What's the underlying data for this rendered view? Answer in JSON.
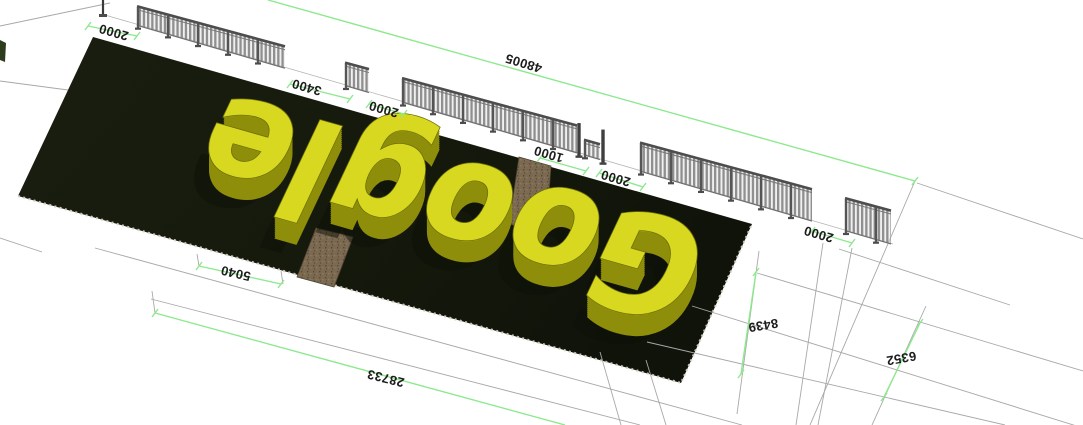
{
  "scene": {
    "letters_word": "Google",
    "colors": {
      "background": "#ffffff",
      "ground_plot": "#161a0c",
      "ground_plot_dark": "#10130a",
      "letters_top": "#d7d81f",
      "letters_side": "#8e8e0b",
      "letters_edge": "#6f7008",
      "letters_shadow": "#0e1107",
      "dimension_green": "#8de98e",
      "construction_gray": "#a8a8a8",
      "fence_gray": "#8f8f8f",
      "fence_rail": "#4d4d4d",
      "path_brown": "#7b6a51",
      "label_text": "#1d1d1d",
      "edge_dots": "#d8d4c6"
    }
  },
  "dimensions": {
    "labels": [
      {
        "value": "2000",
        "x": 114,
        "y": 31,
        "rot": 196
      },
      {
        "value": "3400",
        "x": 307,
        "y": 86,
        "rot": 196
      },
      {
        "value": "2000",
        "x": 384,
        "y": 108,
        "rot": 196
      },
      {
        "value": "1000",
        "x": 549,
        "y": 153,
        "rot": 196
      },
      {
        "value": "2000",
        "x": 616,
        "y": 177,
        "rot": 196
      },
      {
        "value": "2000",
        "x": 819,
        "y": 233,
        "rot": 196
      },
      {
        "value": "48005",
        "x": 524,
        "y": 62,
        "rot": 197
      },
      {
        "value": "5040",
        "x": 236,
        "y": 272,
        "rot": 193
      },
      {
        "value": "28733",
        "x": 386,
        "y": 377,
        "rot": 194
      },
      {
        "value": "8439",
        "x": 763,
        "y": 324,
        "rot": 171
      },
      {
        "value": "6352",
        "x": 901,
        "y": 357,
        "rot": 170
      }
    ]
  },
  "geometry": {
    "plot": [
      [
        93,
        37
      ],
      [
        752,
        224
      ],
      [
        681,
        383
      ],
      [
        18,
        196
      ]
    ],
    "plot_dotted_edge": [
      [
        18,
        196
      ],
      [
        681,
        383
      ],
      [
        752,
        224
      ]
    ],
    "paths_brown": [
      [
        [
          519,
          157
        ],
        [
          551,
          166
        ],
        [
          546,
          233
        ],
        [
          509,
          224
        ]
      ],
      [
        [
          316,
          228
        ],
        [
          353,
          237
        ],
        [
          334,
          287
        ],
        [
          297,
          277
        ]
      ]
    ],
    "left_shrub": [
      [
        0,
        40
      ],
      [
        6,
        43
      ],
      [
        5,
        62
      ],
      [
        0,
        60
      ]
    ],
    "fence": {
      "base_line": [
        105,
        15,
        893,
        244
      ],
      "segments": [
        {
          "x1": 137,
          "x2": 285,
          "type": "fence"
        },
        {
          "x1": 345,
          "x2": 369,
          "type": "fence"
        },
        {
          "x1": 402,
          "x2": 577,
          "type": "fence"
        },
        {
          "x1": 584,
          "x2": 600,
          "type": "panel"
        },
        {
          "x1": 640,
          "x2": 812,
          "type": "fence"
        },
        {
          "x1": 845,
          "x2": 891,
          "type": "fence"
        }
      ],
      "gate_posts": [
        579,
        603
      ],
      "start_post": {
        "x": 103,
        "y_top": 0,
        "y_base": 16
      }
    },
    "green_lines": [
      [
        268,
        0,
        915,
        181
      ],
      [
        88,
        26,
        137,
        36
      ],
      [
        290,
        84,
        350,
        99
      ],
      [
        369,
        104,
        404,
        114
      ],
      [
        540,
        158,
        586,
        171
      ],
      [
        599,
        173,
        643,
        187
      ],
      [
        812,
        231,
        852,
        243
      ],
      [
        199,
        266,
        281,
        284
      ],
      [
        155,
        313,
        565,
        425
      ],
      [
        756,
        272,
        741,
        374
      ],
      [
        920,
        323,
        884,
        397
      ]
    ],
    "green_ticks": [
      [
        915,
        181
      ],
      [
        88,
        26
      ],
      [
        137,
        36
      ],
      [
        290,
        84
      ],
      [
        350,
        99
      ],
      [
        369,
        104
      ],
      [
        404,
        114
      ],
      [
        540,
        158
      ],
      [
        586,
        171
      ],
      [
        599,
        173
      ],
      [
        643,
        187
      ],
      [
        812,
        231
      ],
      [
        852,
        243
      ],
      [
        199,
        266
      ],
      [
        281,
        284
      ],
      [
        155,
        313
      ],
      [
        756,
        272
      ],
      [
        741,
        374
      ],
      [
        920,
        323
      ],
      [
        884,
        397
      ]
    ],
    "gray_lines": [
      [
        0,
        26,
        110,
        3
      ],
      [
        0,
        81,
        68,
        90
      ],
      [
        0,
        238,
        42,
        252
      ],
      [
        95,
        248,
        742,
        425
      ],
      [
        151,
        299,
        640,
        425
      ],
      [
        152,
        291,
        155,
        313
      ],
      [
        197,
        254,
        199,
        266
      ],
      [
        281,
        271,
        283,
        284
      ],
      [
        917,
        183,
        1083,
        239
      ],
      [
        839,
        249,
        1010,
        305
      ],
      [
        757,
        273,
        1083,
        371
      ],
      [
        692,
        306,
        1083,
        428
      ],
      [
        647,
        342,
        1005,
        425
      ],
      [
        915,
        181,
        810,
        425
      ],
      [
        823,
        243,
        796,
        425
      ],
      [
        852,
        248,
        818,
        425
      ],
      [
        759,
        251,
        737,
        414
      ],
      [
        926,
        306,
        872,
        425
      ],
      [
        600,
        352,
        621,
        425
      ],
      [
        646,
        360,
        666,
        425
      ]
    ],
    "letters": {
      "plane_matrix": "matrix(0.659 0.187 -0.075 0.159 93 37)",
      "rotate": "rotate(180 600 475)",
      "scale": "scale(0.276 1)",
      "text_x": 2174,
      "text_y": 725,
      "font_size": 800,
      "text_length": 2720,
      "extrusion": 22,
      "shadow_offset": "translate(-15 70)"
    }
  }
}
